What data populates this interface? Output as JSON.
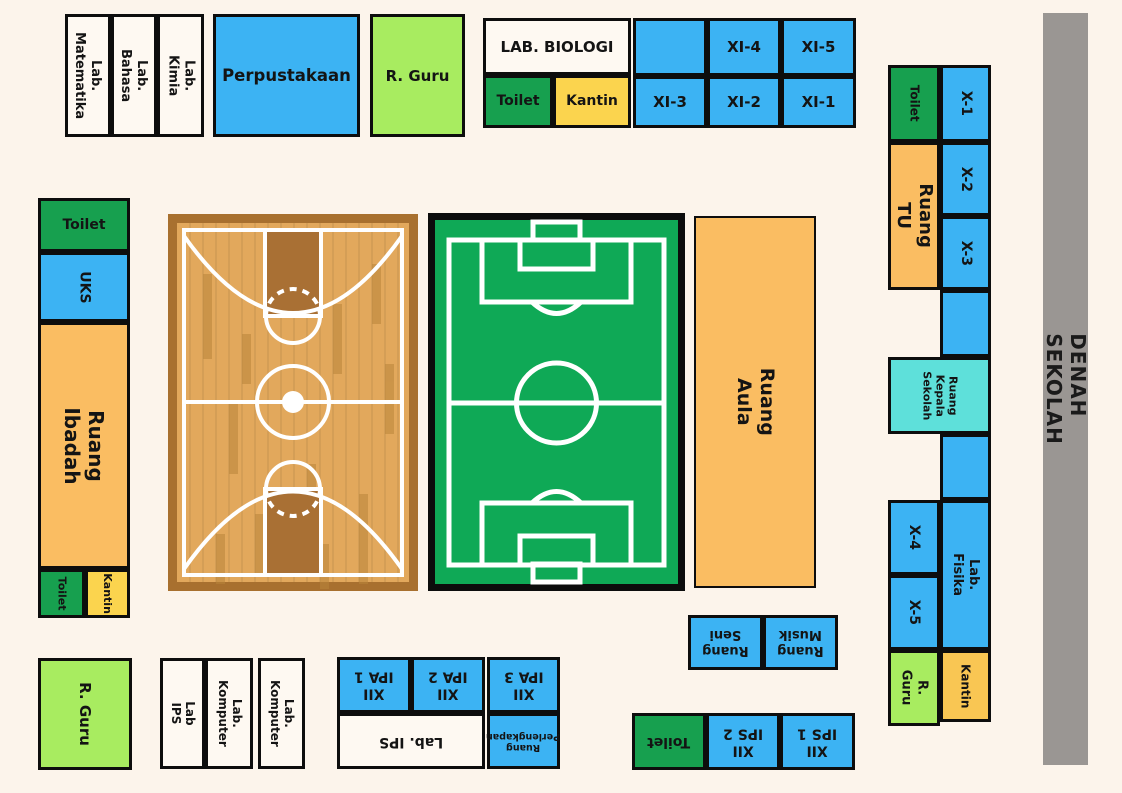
{
  "title": "DENAH SEKOLAH",
  "rooms": {
    "lab_matematika": "Lab.\nMatematika",
    "lab_bahasa": "Lab. Bahasa",
    "lab_kimia": "Lab. Kimia",
    "perpustakaan": "Perpustakaan",
    "r_guru_top": "R. Guru",
    "lab_biologi": "LAB. BIOLOGI",
    "toilet_top": "Toilet",
    "kantin_top": "Kantin",
    "xi_1": "XI-1",
    "xi_2": "XI-2",
    "xi_3": "XI-3",
    "xi_4": "XI-4",
    "xi_5": "XI-5",
    "toilet_right": "Toilet",
    "x_1": "X-1",
    "ruang_tu": "Ruang TU",
    "x_2": "X-2",
    "x_3": "X-3",
    "ruang_kepala_sekolah": "Ruang\nKepala\nSekolah",
    "x_4": "X-4",
    "x_5": "X-5",
    "lab_fisika": "Lab. Fisika",
    "r_guru_right": "R. Guru",
    "kantin_right": "Kantin",
    "toilet_left": "Toilet",
    "uks": "UKS",
    "ruang_ibadah": "Ruang Ibadah",
    "toilet_left_small": "Toilet",
    "kantin_left": "Kantin",
    "r_guru_bottom": "R. Guru",
    "lab_ips_left": "Lab IPS",
    "lab_komputer_1": "Lab. Komputer",
    "lab_komputer_2": "Lab. Komputer",
    "xii_ipa_1": "XII\nIPA 1",
    "xii_ipa_2": "XII\nIPA 2",
    "xii_ipa_3": "XII\nIPA 3",
    "lab_ips_mid": "Lab. IPS",
    "ruang_perlengkapan": "Ruang\nPerlengkapan",
    "ruang_seni": "Ruang\nSeni",
    "ruang_musik": "Ruang\nMusik",
    "toilet_bottom": "Toilet",
    "xii_ips_2": "XII\nIPS 2",
    "xii_ips_1": "XII\nIPS 1",
    "ruang_aula": "Ruang Aula"
  },
  "colors": {
    "background": "#FCF4EB",
    "classroom_blue": "#3CB3F3",
    "toilet_green": "#17A04F",
    "kantin_yellow": "#FBD44E",
    "office_orange": "#FABD62",
    "guru_light_green": "#A8EC60",
    "kepala_sekolah_teal": "#5EE0DA",
    "title_bar_gray": "#9A9693",
    "white_room": "#FEF9F2",
    "court_wood": "#E2A85C",
    "court_wood_border": "#A8702F",
    "field_green": "#0FA956"
  }
}
